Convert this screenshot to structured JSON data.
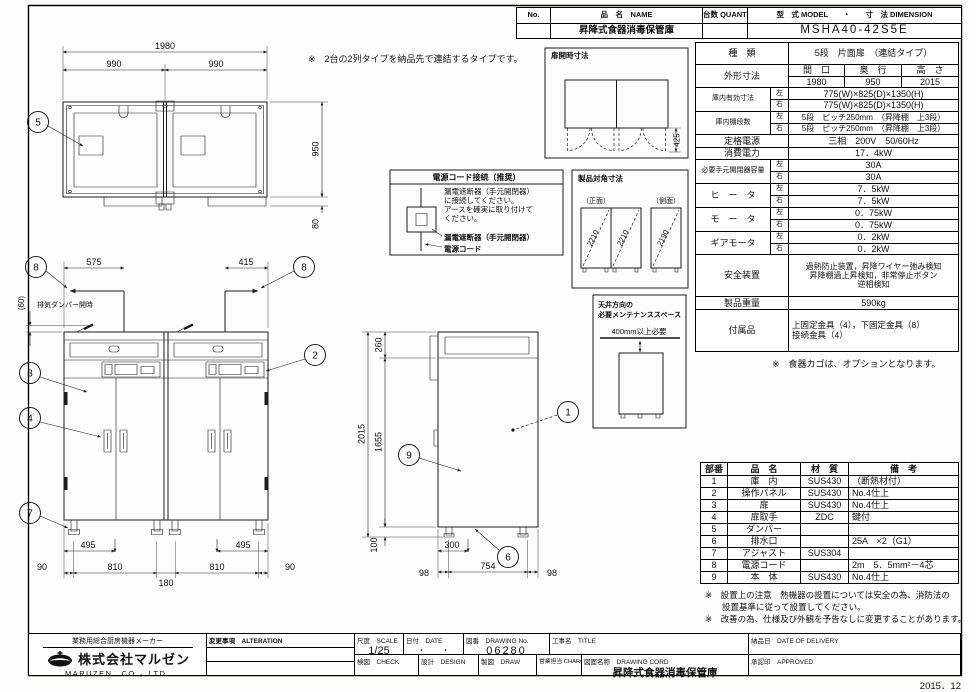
{
  "header": {
    "no_label": "No.",
    "name_label": "品　名　NAME",
    "qty_label": "台数 QUANTITY",
    "model_dim_label": "型　式 MODEL　　・　　寸　法 DIMENSION",
    "name_value": "昇降式食器消毒保管庫",
    "model_value": "MSHA40-42S5E"
  },
  "spec": {
    "kind_label": "種　類",
    "kind_value": "5段　片面扉　（連結タイプ）",
    "outer_label": "外形寸法",
    "w_label": "間　口",
    "d_label": "奥　行",
    "h_label": "高　さ",
    "w": "1980",
    "d": "950",
    "h": "2015",
    "inner_label": "庫内有効寸法",
    "left": "左",
    "right": "右",
    "inner_left": "775(W)×825(D)×1350(H)",
    "inner_right": "775(W)×825(D)×1350(H)",
    "shelf_label": "庫内棚段数",
    "shelf_left": "5段　ピッチ250mm　（昇降棚　上3段）",
    "shelf_right": "5段　ピッチ250mm　（昇降棚　上3段）",
    "power_label": "定格電源",
    "power_value": "三相　200V　50/60Hz",
    "consumption_label": "消費電力",
    "consumption_value": "17．4kW",
    "breaker_label": "必要手元開閉器容量",
    "breaker_left": "30A",
    "breaker_right": "30A",
    "heater_label": "ヒ　ー　タ",
    "heater_left": "7．5kW",
    "heater_right": "7．5kW",
    "motor_label": "モ　ー　タ",
    "motor_left": "0．75kW",
    "motor_right": "0．75kW",
    "gear_label": "ギアモータ",
    "gear_left": "0．2kW",
    "gear_right": "0．2kW",
    "safety_label": "安全装置",
    "safety_line1": "過熱防止装置，昇降ワイヤー弛み検知",
    "safety_line2": "昇降棚過上昇検知，非常停止ボタン",
    "safety_line3": "逆相検知",
    "weight_label": "製品重量",
    "weight_value": "590kg",
    "accessory_label": "付属品",
    "accessory_line1": "上固定金具（4），下固定金具（8）",
    "accessory_line2": "接続金具（4）",
    "option_note": "※　食器カゴは、オプションとなります。"
  },
  "parts": {
    "headers": [
      "部番",
      "品　名",
      "材　質",
      "備　考"
    ],
    "rows": [
      [
        "1",
        "庫　内",
        "SUS430",
        "（断熱材付）"
      ],
      [
        "2",
        "操作パネル",
        "SUS430",
        "No.4仕上"
      ],
      [
        "3",
        "扉",
        "SUS430",
        "No.4仕上"
      ],
      [
        "4",
        "扉取手",
        "ZDC",
        "鍵付"
      ],
      [
        "5",
        "ダンパー",
        "",
        ""
      ],
      [
        "6",
        "排水口",
        "",
        "25A　×2（G1）"
      ],
      [
        "7",
        "アジャスト",
        "SUS304",
        ""
      ],
      [
        "8",
        "電源コード",
        "",
        "2m　5．5mm²－4芯"
      ],
      [
        "9",
        "本　体",
        "SUS430",
        "No.4仕上"
      ]
    ]
  },
  "notes": {
    "note1a": "※　設置上の注意　熱機器の設置については安全の為、消防法の",
    "note1b": "設置基準に従って設置してください。",
    "note2": "※　改善の為、仕様及び外観を予告なしに変更することがあります。"
  },
  "footer": {
    "tagline": "業務用総合厨房機器メーカー",
    "company": "株式会社マルゼン",
    "company_en": "MARUZEN　CO.，LTD.",
    "alteration_label": "変更事項　ALTERATION",
    "scale_label": "尺度　SCALE",
    "scale_value": "1/25",
    "date_label": "日付　DATE",
    "date_value": "・　　・",
    "dwg_no_label": "図番　DRAWING No.",
    "dwg_no_value": "06280",
    "title_label": "工事名　TITLE",
    "delivery_label": "納品日　DATE OF DELIVERY",
    "check_label": "検図　CHECK",
    "design_label": "設計　DESIGN",
    "draw_label": "製図　DRAW",
    "charge_label": "営業担当 CHARGE",
    "dwg_name_label": "図面名称　DRAWING CORD",
    "dwg_name_value": "昇降式食器消毒保管庫",
    "approved_label": "承認印　APPROVED",
    "issue_date": "2015．12"
  },
  "drawing": {
    "top_note": "※　2台の2列タイプを納品先で連結するタイプです。",
    "plan": {
      "d1980": "1980",
      "d990a": "990",
      "d990b": "990",
      "d950": "950",
      "d80": "80"
    },
    "front": {
      "d575": "575",
      "d415": "415",
      "d60": "(60)",
      "exhaust": "排気ダンパー開時",
      "d495a": "495",
      "d495b": "495",
      "d90a": "90",
      "d810a": "810",
      "d180": "180",
      "d810b": "810",
      "d90b": "90"
    },
    "side": {
      "d260": "260",
      "d2015": "2015",
      "d1655": "1655",
      "d100": "100",
      "d300": "300",
      "d98a": "98",
      "d754": "754",
      "d98b": "98"
    },
    "door_open": {
      "title": "扉開時寸法",
      "d425": "425"
    },
    "power": {
      "title": "電源コード接続（推奨）",
      "line1": "漏電遮断器（手元開閉器）",
      "line2": "に接続してください。",
      "line3": "アースを確実に取り付けて",
      "line4": "ください。",
      "label1": "漏電遮断器（手元開閉器）",
      "label2": "電源コード"
    },
    "diagonal": {
      "title": "製品対角寸法",
      "front": "（正面）",
      "side": "（側面）",
      "d2210a": "2210",
      "d2210b": "2210",
      "d2190": "2190"
    },
    "ceiling": {
      "title1": "天井方向の",
      "title2": "必要メンテナンススペース",
      "clearance": "400mm以上必要"
    },
    "balloons": {
      "n1": "1",
      "n2": "2",
      "n3": "3",
      "n4": "4",
      "n5": "5",
      "n6": "6",
      "n7": "7",
      "n8": "8",
      "n9": "9"
    }
  }
}
